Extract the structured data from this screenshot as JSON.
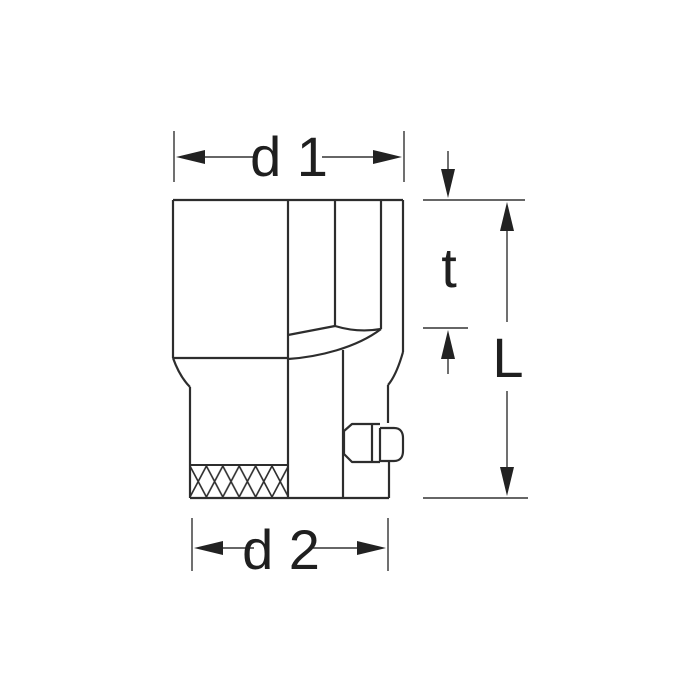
{
  "page": {
    "background": "#ffffff"
  },
  "drawing": {
    "subject": "socket-side-view-technical-drawing",
    "line_color": "#2d2d2d",
    "dimension_color": "#333333",
    "labels": {
      "d1": "d 1",
      "t": "t",
      "L": "L",
      "d2": "d 2"
    }
  }
}
